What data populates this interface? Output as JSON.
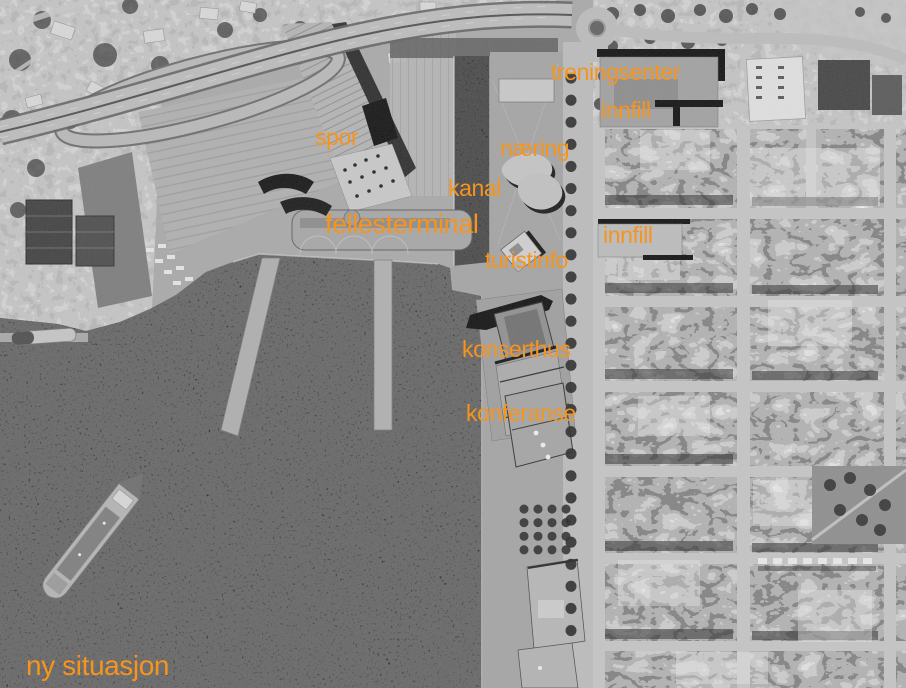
{
  "map": {
    "caption": "ny situasjon",
    "accent_color": "#f7941e",
    "water_color": "#0a0a0a",
    "land_color": "#a9a9a9",
    "street_color": "#c6c6c6",
    "labels": [
      {
        "id": "treningsenter",
        "text": "treningsenter",
        "x": 551,
        "y": 61,
        "size": 23
      },
      {
        "id": "innfill-nord",
        "text": "innfill",
        "x": 601,
        "y": 99,
        "size": 23
      },
      {
        "id": "spor",
        "text": "spor",
        "x": 315,
        "y": 126,
        "size": 23
      },
      {
        "id": "naering",
        "text": "næring",
        "x": 500,
        "y": 137,
        "size": 23
      },
      {
        "id": "kanal",
        "text": "kanal",
        "x": 448,
        "y": 177,
        "size": 23
      },
      {
        "id": "fellesterminal",
        "text": "fellesterminal",
        "x": 325,
        "y": 211,
        "size": 27
      },
      {
        "id": "innfill-sentrum",
        "text": "innfill",
        "x": 603,
        "y": 224,
        "size": 23
      },
      {
        "id": "turistinfo",
        "text": "turistinfo",
        "x": 485,
        "y": 249,
        "size": 23
      },
      {
        "id": "konserthus",
        "text": "konserthus",
        "x": 462,
        "y": 338,
        "size": 23
      },
      {
        "id": "konferanse",
        "text": "konferanse",
        "x": 466,
        "y": 402,
        "size": 23
      },
      {
        "id": "ny-situasjon",
        "text": "ny situasjon",
        "x": 26,
        "y": 652,
        "size": 28
      }
    ]
  }
}
